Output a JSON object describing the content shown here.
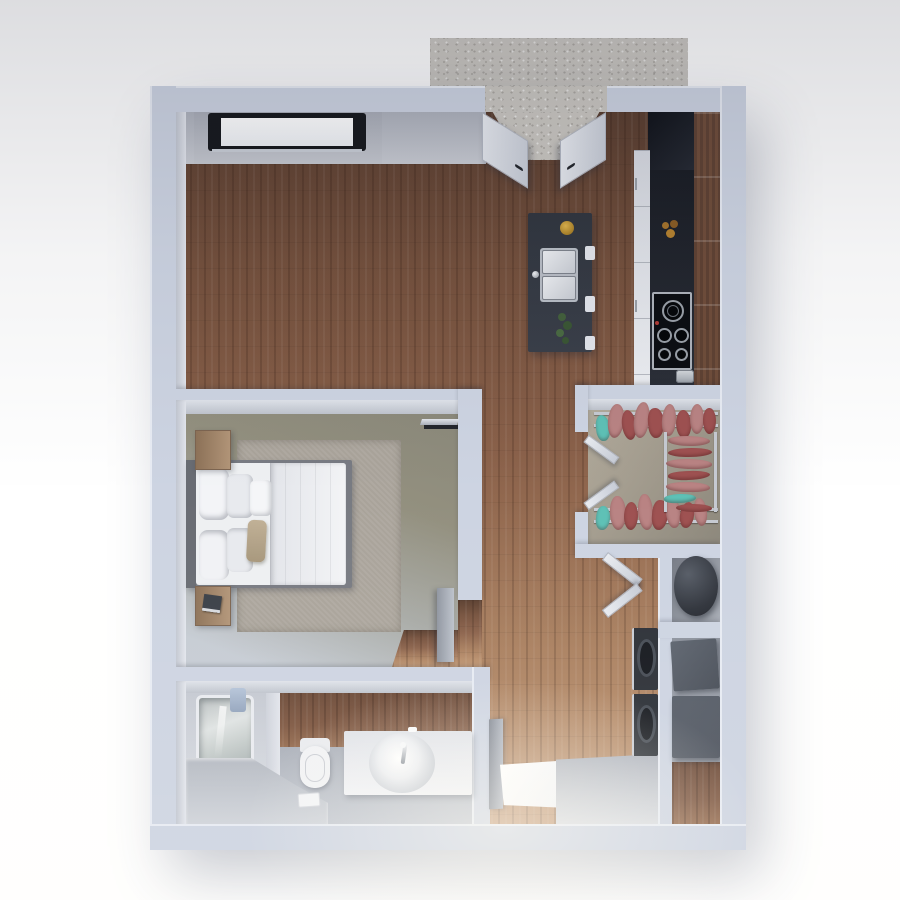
{
  "scene": {
    "description": "3D rendered top-down floor plan of a one-bedroom apartment, no text labels visible",
    "rooms": [
      {
        "name": "patio",
        "floor": "concrete-slab"
      },
      {
        "name": "living-kitchen-area",
        "floor": "wood-plank"
      },
      {
        "name": "bedroom",
        "floor": "olive-gray"
      },
      {
        "name": "walk-in-closet",
        "floor": "beige-gray"
      },
      {
        "name": "bathroom",
        "floor": "gray-with-wood-accent"
      },
      {
        "name": "laundry-utility-area",
        "floor": "wood-plank"
      },
      {
        "name": "entry-hall",
        "floor": "wood-and-gray-landing"
      }
    ],
    "furniture_and_fixtures": [
      "double-entry-doors-top",
      "wall-window-top",
      "kitchen-tall-black-unit",
      "kitchen-black-counter",
      "kitchen-white-cabinet-fronts",
      "kitchen-wood-upper-cabinets",
      "cooktop-4-burners",
      "toaster",
      "flower-jar",
      "kitchen-island",
      "double-basin-sink",
      "island-faucet",
      "yellow-dish",
      "island-plant",
      "bar-stool-tabs",
      "clothes-rack-top",
      "clothes-rack-bottom",
      "clothes-rack-right",
      "closet-double-doors",
      "bed",
      "headboard",
      "pillows",
      "beige-lumbar-pillow",
      "duvet",
      "area-rug",
      "nightstand-top",
      "nightstand-bottom",
      "book-stack",
      "wall-mounted-tv",
      "sliding-door-panel",
      "bathtub",
      "tub-faucet",
      "blue-towel",
      "toilet",
      "vanity",
      "round-sink-basin",
      "vanity-faucet",
      "bath-mat",
      "bathroom-door-open",
      "entry-landing",
      "laundry-bifold-door",
      "washer",
      "dryer",
      "water-heater",
      "storage-box-small",
      "storage-box-large",
      "entry-threshold"
    ]
  },
  "colors": {
    "wall": "#cdd4e2",
    "wall_light": "#e7ebf3",
    "wall_face": "#b7bcc7",
    "wood_dark": "#5a3e2f",
    "wood_mid": "#8a614a",
    "wood_light": "#c49a76",
    "bedroom_floor": "#8a887a",
    "bedroom_floor_light": "#c6ccd4",
    "closet_floor": "#a59e90",
    "bath_floor": "#a8adb7",
    "concrete": "#cac7c1",
    "counter_black": "#1a1d24",
    "island_gray": "#3a3f49",
    "cabinet_wood": "#6b4b39",
    "appliance_dark": "#2b2f36",
    "box_gray": "#4f5560",
    "clothes_rose": "#b98383",
    "clothes_red": "#9e5151",
    "clothes_teal": "#5ec1b6",
    "bed_white": "#eef0f2",
    "rug_gray": "#a9a39a",
    "chrome": "#c6cad2"
  }
}
